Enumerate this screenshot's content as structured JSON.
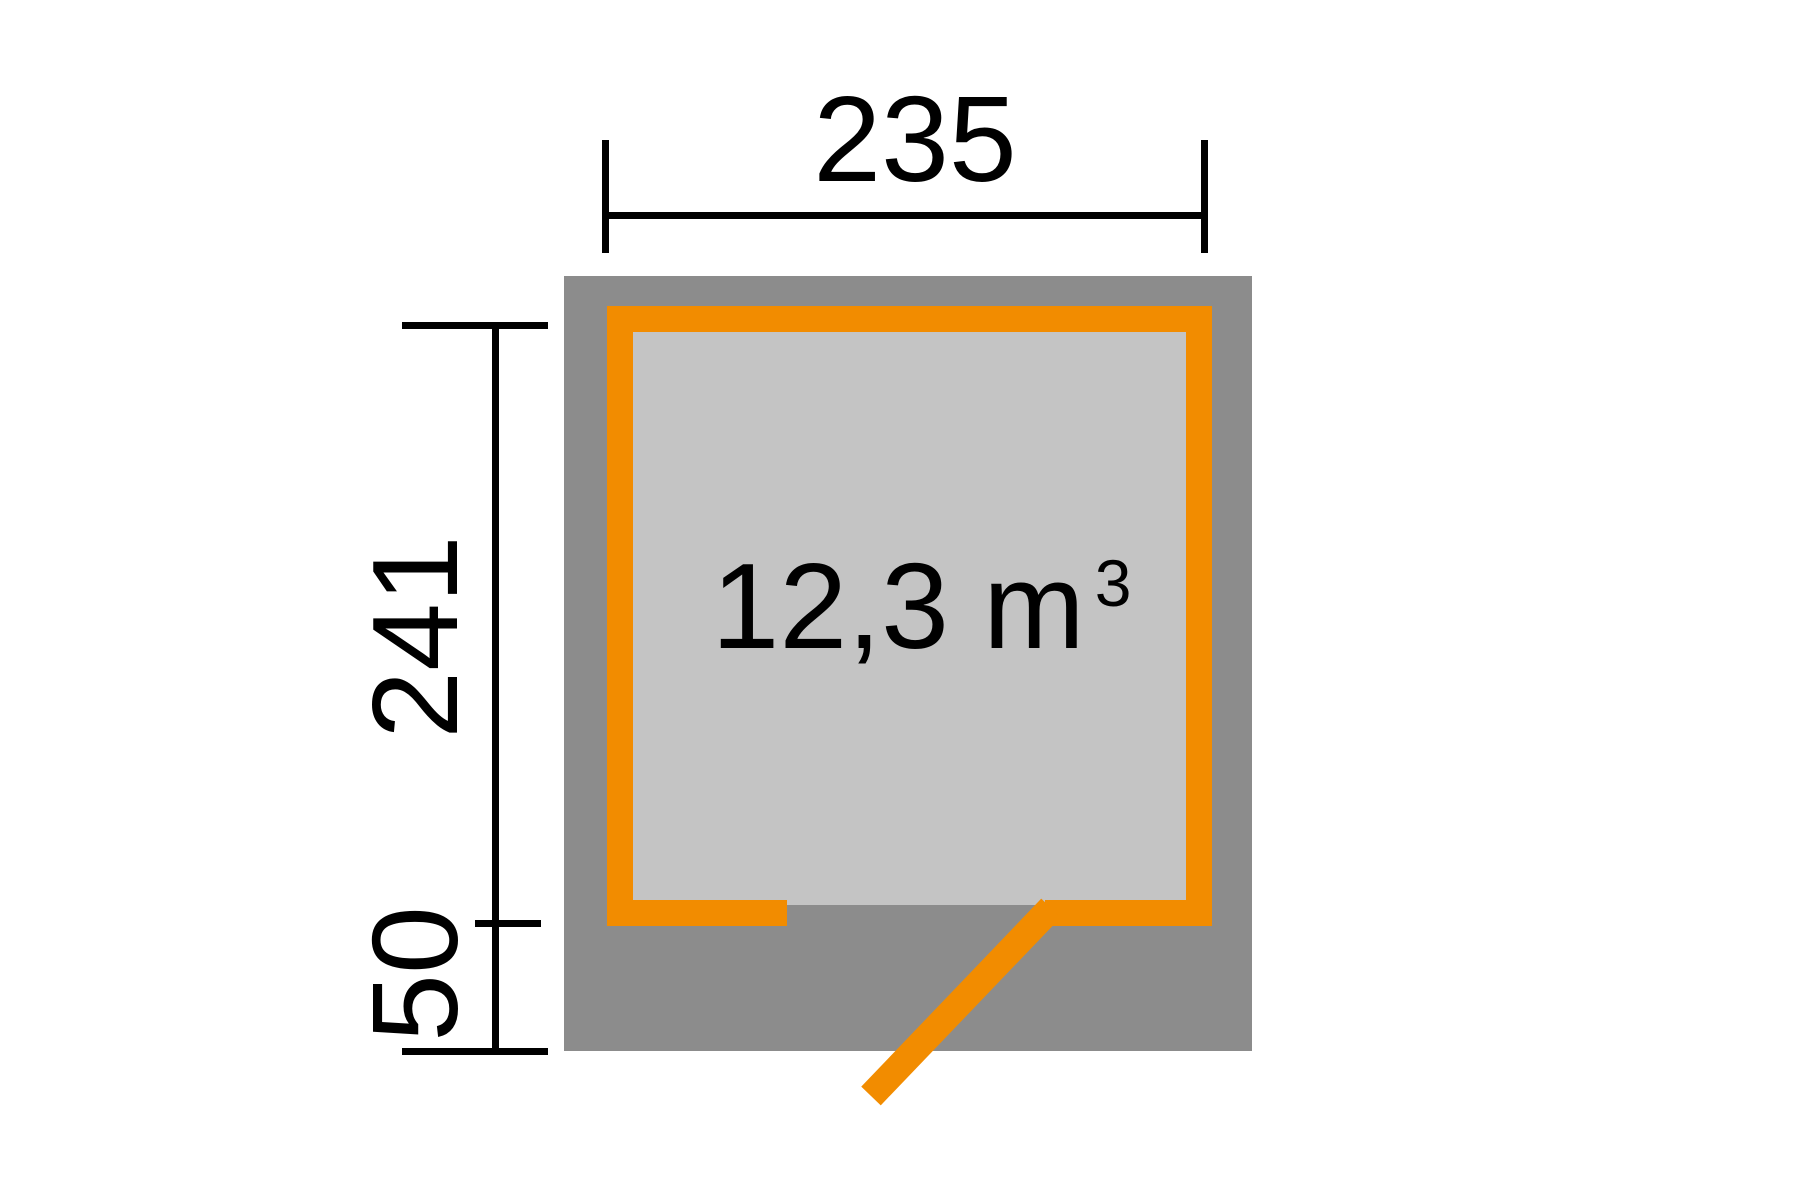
{
  "diagram": {
    "type": "shed-floorplan",
    "dimensions": {
      "width": {
        "value": "235"
      },
      "depth": {
        "value": "241"
      },
      "front_offset": {
        "value": "50"
      }
    },
    "volume": {
      "value": "12,3",
      "unit": "m",
      "exponent": "3"
    },
    "colors": {
      "wall_orange": "#F28C00",
      "roof_gray": "#8C8C8C",
      "interior_gray": "#C4C4C4",
      "line_black": "#000000",
      "background": "#FFFFFF"
    }
  }
}
